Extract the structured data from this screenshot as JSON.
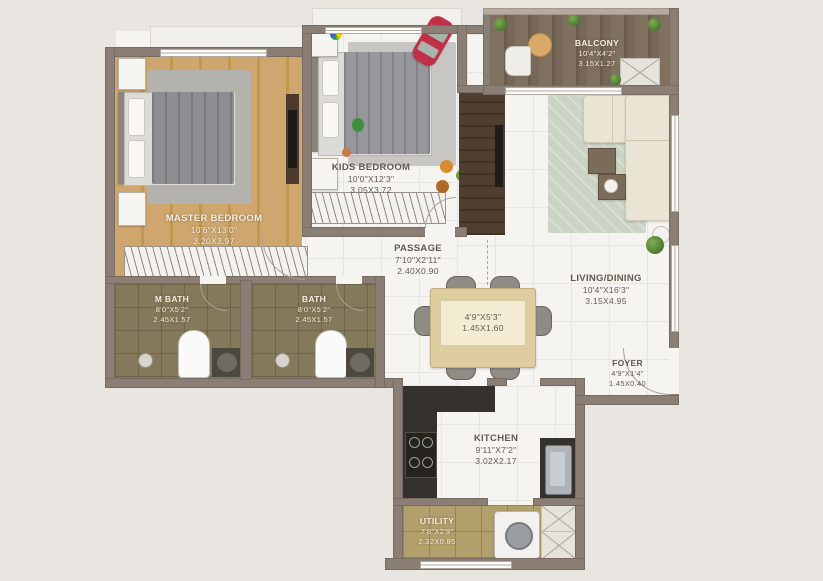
{
  "plan_type": "2BHK apartment floor plan",
  "rooms": {
    "master_bedroom": {
      "name": "MASTER BEDROOM",
      "imperial": "10'6\"X13'0\"",
      "metric": "3.20X3.97"
    },
    "kids_bedroom": {
      "name": "KIDS BEDROOM",
      "imperial": "10'0\"X12'3\"",
      "metric": "3.05X3.72"
    },
    "balcony": {
      "name": "BALCONY",
      "imperial": "10'4\"X4'2\"",
      "metric": "3.15X1.27"
    },
    "passage": {
      "name": "PASSAGE",
      "imperial": "7'10\"X2'11\"",
      "metric": "2.40X0.90"
    },
    "living_dining": {
      "name": "LIVING/DINING",
      "imperial": "10'4\"X16'3\"",
      "metric": "3.15X4.95"
    },
    "m_bath": {
      "name": "M BATH",
      "imperial": "8'0\"X5'2\"",
      "metric": "2.45X1.57"
    },
    "bath": {
      "name": "BATH",
      "imperial": "8'0\"X5'2\"",
      "metric": "2.45X1.57"
    },
    "dining_table": {
      "imperial": "4'9\"X5'3\"",
      "metric": "1.45X1.60"
    },
    "foyer": {
      "name": "FOYER",
      "imperial": "4'9\"X1'4\"",
      "metric": "1.45X0.40"
    },
    "kitchen": {
      "name": "KITCHEN",
      "imperial": "9'11\"X7'2\"",
      "metric": "3.02X2.17"
    },
    "utility": {
      "name": "UTILITY",
      "imperial": "7'8\"X2'9\"",
      "metric": "2.32X0.85"
    }
  },
  "colors": {
    "background": "#e9e6e2",
    "wall": "#8b7e74",
    "wood_floor": "#c9a05e",
    "balcony_wood": "#77675a",
    "bath_tile": "#84795a",
    "utility_floor": "#b1a06c",
    "counter_dark": "#35312c",
    "sofa_cream": "#eae4d4",
    "living_rug": "#cbd4c4",
    "toy_car_red": "#c03048",
    "text_light": "#f4efe4",
    "text_dark": "#615a4f"
  },
  "icons": [
    "bed",
    "wardrobe-hangers",
    "toilet",
    "washbasin",
    "shower-head",
    "gas-stove",
    "kitchen-sink",
    "washing-machine",
    "sofa",
    "coffee-table",
    "dining-table",
    "dining-chair",
    "tv-unit",
    "toy-car",
    "plant",
    "planter-box",
    "balcony-table",
    "balcony-chair"
  ]
}
